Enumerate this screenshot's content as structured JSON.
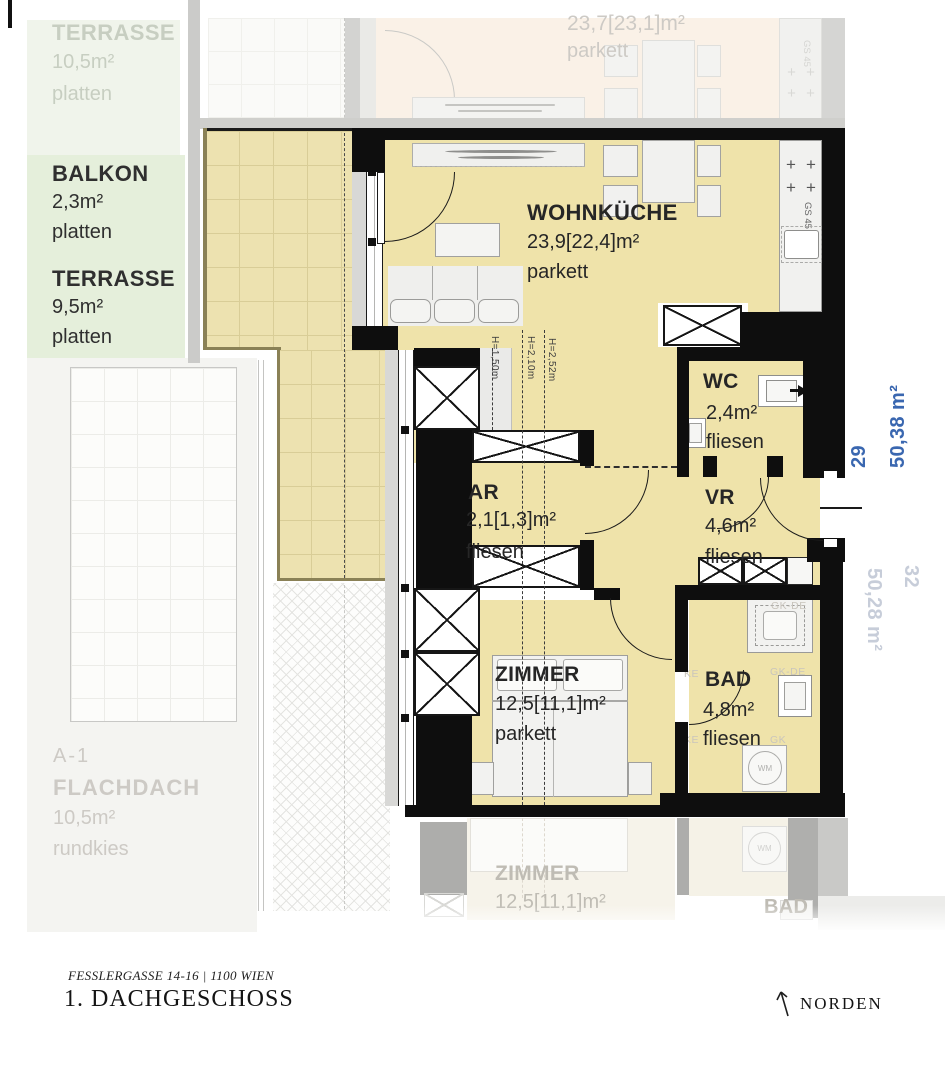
{
  "panels": {
    "terrasse_upper": {
      "name": "TERRASSE",
      "area": "10,5m²",
      "floor": "platten"
    },
    "balkon": {
      "name": "BALKON",
      "area": "2,3m²",
      "floor": "platten"
    },
    "terrasse": {
      "name": "TERRASSE",
      "area": "9,5m²",
      "floor": "platten"
    },
    "flachdach": {
      "code": "A-1",
      "name": "FLACHDACH",
      "area": "10,5m²",
      "floor": "rundkies"
    }
  },
  "neighbor_above": {
    "area": "23,7[23,1]m²",
    "floor": "parkett"
  },
  "rooms": {
    "wohnkueche": {
      "name": "WOHNKÜCHE",
      "area": "23,9[22,4]m²",
      "floor": "parkett"
    },
    "wc": {
      "name": "WC",
      "area": "2,4m²",
      "floor": "fliesen"
    },
    "ar": {
      "name": "AR",
      "area": "2,1[1,3]m²",
      "floor": "fliesen"
    },
    "vr": {
      "name": "VR",
      "area": "4,6m²",
      "floor": "fliesen"
    },
    "zimmer": {
      "name": "ZIMMER",
      "area": "12,5[11,1]m²",
      "floor": "parkett"
    },
    "bad": {
      "name": "BAD",
      "area": "4,8m²",
      "floor": "fliesen"
    }
  },
  "annotations": {
    "apartment_number": "29",
    "apartment_area": "50,38 m²",
    "neighbor_number": "32",
    "neighbor_area": "50,28 m²",
    "heights": {
      "h1": "H=1,50m",
      "h2": "H=2,10m",
      "h3": "H=2,52m"
    },
    "gs": "GS 45",
    "wm": "WM",
    "gk1": "GK-DE",
    "gk2": "GK-DE",
    "gk3": "KE",
    "gk4": "GK",
    "gk5": "KE"
  },
  "reflection": {
    "zimmer": "ZIMMER",
    "zimmer_area": "12,5[11,1]m²",
    "bad": "BAD",
    "wm": "WM"
  },
  "footer": {
    "address": "FESSLERGASSE 14-16 | 1100 WIEN",
    "title": "1. DACHGESCHOSS",
    "north": "NORDEN"
  },
  "colors": {
    "accent_blue": "#3A67B0",
    "floor_yellow": "#EFE3AA",
    "terrace_yellow": "#EDE2B0",
    "panel_green": "#E5EFDB",
    "wall_black": "#0e0e0e"
  }
}
